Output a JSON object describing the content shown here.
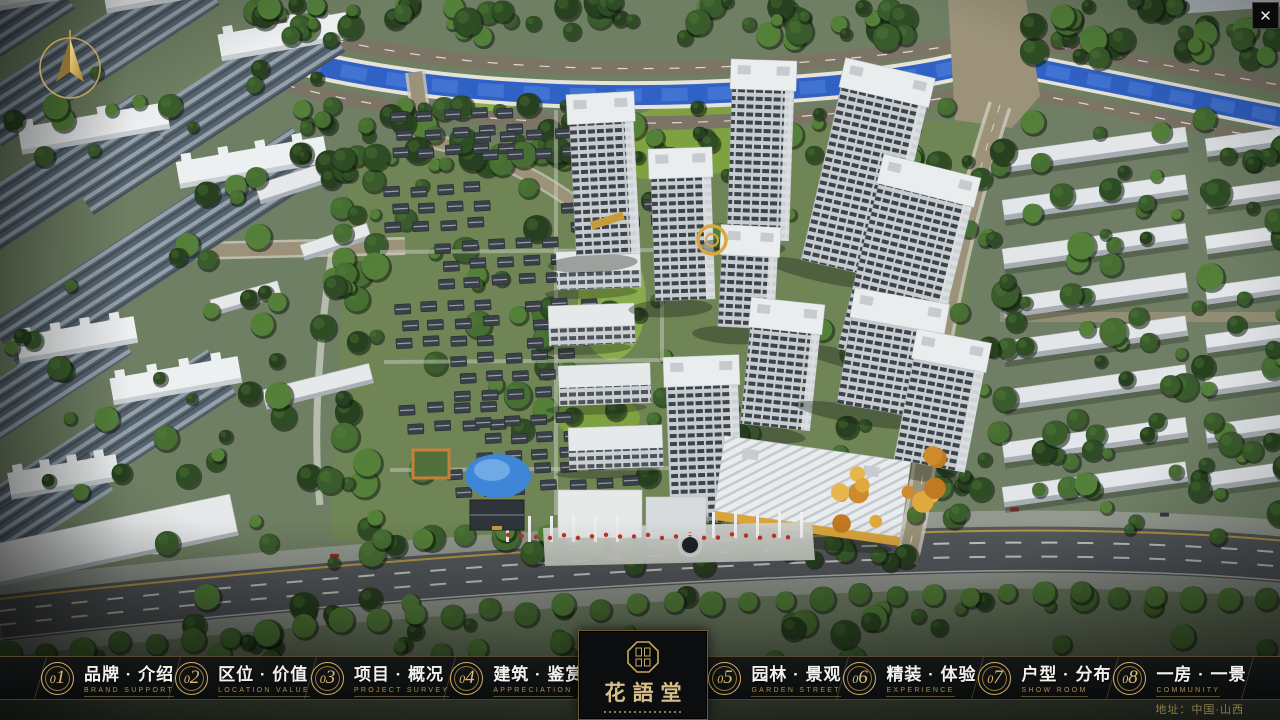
{
  "window": {
    "close_glyph": "✕"
  },
  "logo": {
    "name": "花語堂"
  },
  "nav": {
    "items": [
      {
        "num": "01",
        "zh": "品牌 · 介绍",
        "en": "BRAND SUPPORT"
      },
      {
        "num": "02",
        "zh": "区位 · 价值",
        "en": "LOCATION VALUE"
      },
      {
        "num": "03",
        "zh": "项目 · 概况",
        "en": "PROJECT SURVEY"
      },
      {
        "num": "04",
        "zh": "建筑 · 鉴赏",
        "en": "APPRECIATION"
      },
      {
        "num": "05",
        "zh": "园林 · 景观",
        "en": "GARDEN STREET"
      },
      {
        "num": "06",
        "zh": "精装 · 体验",
        "en": "EXPERIENCE"
      },
      {
        "num": "07",
        "zh": "户型 · 分布",
        "en": "SHOW ROOM"
      },
      {
        "num": "08",
        "zh": "一房 · 一景",
        "en": "COMMUNITY"
      }
    ]
  },
  "footer": {
    "address": "地址：中国·山西"
  },
  "colors": {
    "gold": "#c9a85c",
    "gold_text": "#d8bf8a",
    "bar_background": "#0b0d0f",
    "river_blue": "#3061c4",
    "label_white": "#f2f1ec",
    "label_gold": "#aa8f50"
  }
}
